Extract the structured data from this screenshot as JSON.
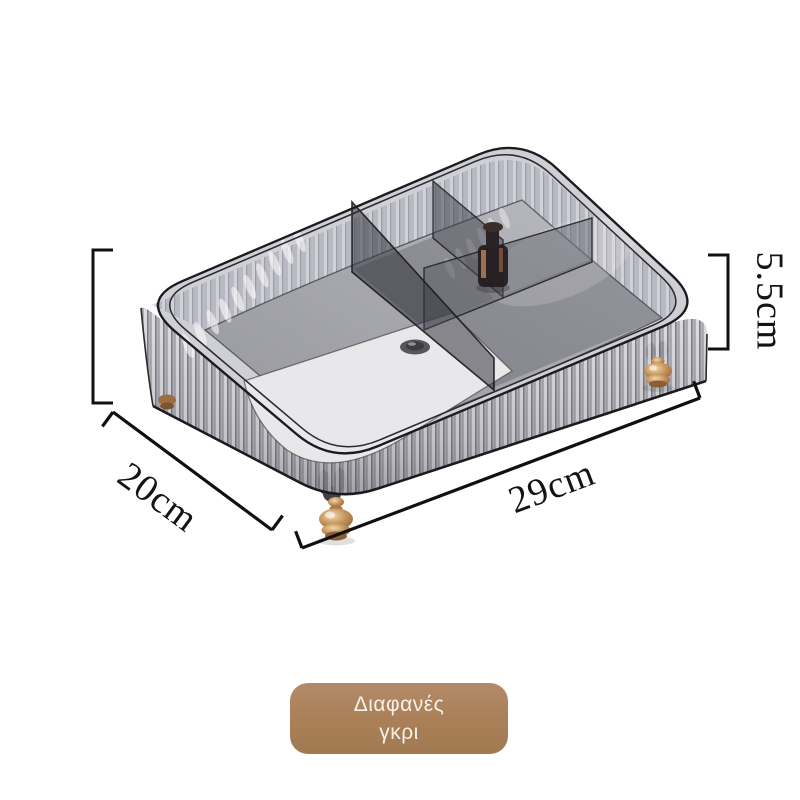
{
  "scene": {
    "background": "#ffffff",
    "product": {
      "type": "storage-box",
      "description_parts": [
        "ribbed-transparent-gray-organizer",
        "four-compartments",
        "gold-feet"
      ],
      "material_colors": {
        "wall_gray": "#b9b9c0",
        "rim_gray": "#cfcfd6",
        "floor_gray": "#a3a3aa",
        "divider_gray": "#5c5c66",
        "panel_white": "#e8e7e9",
        "gold": "#c49259",
        "outline": "#1c1c20"
      }
    },
    "dimensions": {
      "height": {
        "label": "5.5cm"
      },
      "depth": {
        "label": "20cm"
      },
      "width": {
        "label": "29cm"
      },
      "line_color": "#101010"
    },
    "variant_chip": {
      "line1": "Διαφανές",
      "line2": "γκρι",
      "background": "#ab8159",
      "text_color": "#f6f1ea"
    }
  }
}
